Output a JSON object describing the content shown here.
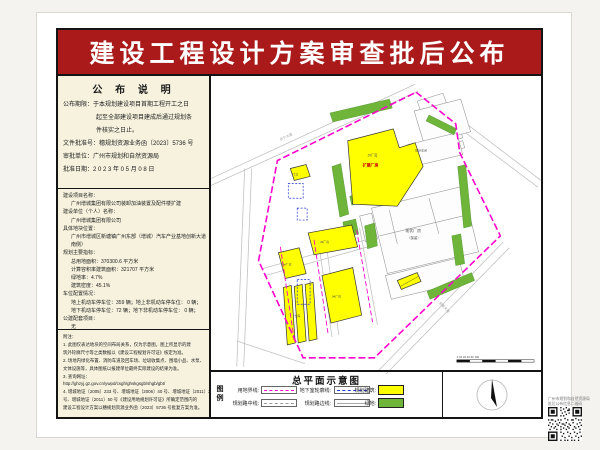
{
  "banner": {
    "title": "建设工程设计方案审查批后公布"
  },
  "left_panel": {
    "announcement": {
      "title": "公 布 说 明",
      "lines": [
        "公布期限：于本规划建设项目首期工程开工之日",
        "起至全部建设项目建成后通过规划条",
        "件核实之日止。",
        "文件批准号：穗规划资源业务函〔2023〕5736 号",
        "审批单位：广州市规划和自然资源局",
        "批准日期：2 0 2 3 年 0 5 月 0 8 日"
      ]
    },
    "project_info": {
      "lines": [
        "建设项目名称：",
        "广州增城集团有限公司装卸加油装置及配件楼扩建",
        "建设单位（个人）名称：",
        "广州增城集团有限公司",
        "具体地块位置：",
        "广州市增城区新塘镇广州东部（增城）汽车产业基地创新大道",
        "南侧）",
        "规划主要指标：",
        "总用地面积：370300.6 平方米",
        "计算容积率建筑面积：321707 平方米",
        "绿地率：4.7%",
        "建筑密度：45.1%",
        "车位配置情况：",
        "地上机动车停车位：359 辆；地上非机动车停车位：    0  辆；",
        "地下机动车停车位：72  辆；地下非机动车停车位：    0  辆；",
        "公建配套项目：",
        "无"
      ]
    },
    "notes": {
      "lines": [
        "附注：",
        "1. 此图仅表达地块的空间布局关系，仅为示意图，图上所显示的建",
        "   筑外轮廓尺寸等之类数据以《建设工程规划许可证》核定为准。",
        "2. 场地内绿化布置、消防车道及回车场、垃圾收集点、围墙小品、水泵、",
        "   文体设施等，具体图纸以报建单位最终实际建设的结果为准。",
        "3. 查询网址：",
        "   http://ghzyj.gz.gov.cn/ywpd/csgh/ghskgsgb/shgb/gbt/",
        "4. 增城地证〔2005〕233 号、增城地证〔2006〕40 号、增城地证〔2011〕20",
        "   号、增城地证〔2011〕50 号《建设用地规划许可证》所确定范围内的",
        "   建设工程设计方案以穗规划资源业务函〔2023〕5736 号批复方案为准。"
      ]
    }
  },
  "map": {
    "title": "总平面示意图",
    "labels": {
      "road_top": "永宁大道",
      "road_se": "创新大道",
      "main_building": "2#厂房",
      "main_building_red": "扩建厂房",
      "existing_1": "现状厂房",
      "existing_2": "（保留）",
      "workshop": "现状车间",
      "b3": "3#厂房",
      "b4": "4#厂房",
      "b5": "5#厂房",
      "warehouse": "仓库",
      "gate": "门卫",
      "scale_text": "0  10  20   40   60   100"
    }
  },
  "legend": {
    "header": "图例",
    "items": [
      {
        "label": "用地界线:"
      },
      {
        "label": "地下室轮廓线:"
      },
      {
        "label": "规划建筑:"
      },
      {
        "label": "规划路中线:"
      },
      {
        "label": "规划路边线:"
      },
      {
        "label": "绿地:"
      }
    ]
  },
  "qr": {
    "caption1": "广州市规划和自然资源局",
    "caption2": "批后公布信息二维码"
  },
  "colors": {
    "banner_red": "#AB1A1A",
    "panel_cream": "#F6F2DE",
    "boundary_magenta": "#FF00CC",
    "building_yellow": "#FFFF00",
    "green_area": "#6FB53A",
    "basement_blue": "#2233CC"
  }
}
